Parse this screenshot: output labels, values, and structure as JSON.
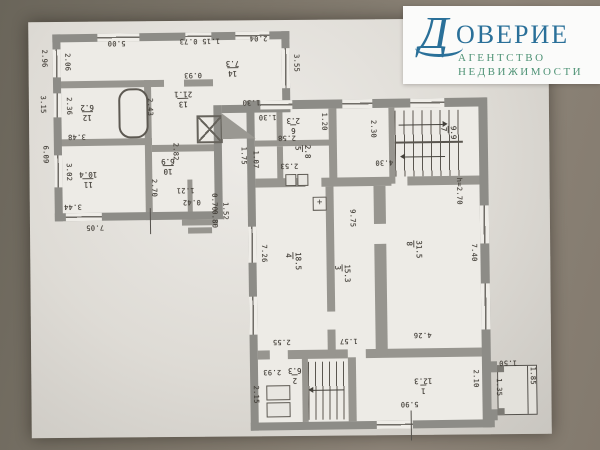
{
  "logo": {
    "brand_initial": "Д",
    "brand_rest": "ОВЕРИЕ",
    "tagline_line1": "АГЕНТСТВО",
    "tagline_line2": "НЕДВИЖИМОСТИ"
  },
  "colors": {
    "logo_blue": "#2a7099",
    "logo_green": "#4f9376",
    "paper": "#dedbd5",
    "wall_grey": "#8d8c87",
    "background": "#7b7468"
  },
  "symbols": {
    "cross_box": "+"
  },
  "plan": {
    "height_note": "h=2.70",
    "room_labels": [
      {
        "num": "13",
        "area": "21.1",
        "x": 176,
        "y": 88,
        "rot": 180
      },
      {
        "num": "12",
        "area": "6.2",
        "x": 82,
        "y": 100,
        "rot": 180
      },
      {
        "num": "14",
        "area": "7.3",
        "x": 228,
        "y": 58,
        "rot": 180
      },
      {
        "num": "11",
        "area": "10.4",
        "x": 80,
        "y": 167,
        "rot": 180
      },
      {
        "num": "10",
        "area": "6.9",
        "x": 162,
        "y": 155,
        "rot": 180
      },
      {
        "num": "6",
        "area": "2.3",
        "x": 288,
        "y": 116,
        "rot": 180
      },
      {
        "num": "5",
        "area": "2.8",
        "x": 294,
        "y": 145,
        "rot": 90
      },
      {
        "num": "7",
        "area": "9.9",
        "x": 440,
        "y": 128,
        "rot": 90
      },
      {
        "num": "4",
        "area": "18.5",
        "x": 283,
        "y": 252,
        "rot": 90
      },
      {
        "num": "3",
        "area": "15.3",
        "x": 332,
        "y": 265,
        "rot": 90
      },
      {
        "num": "8",
        "area": "31.5",
        "x": 404,
        "y": 242,
        "rot": 90
      },
      {
        "num": "2",
        "area": "6.3",
        "x": 286,
        "y": 366,
        "rot": 180
      },
      {
        "num": "1",
        "area": "12.3",
        "x": 412,
        "y": 378,
        "rot": 180
      }
    ],
    "dimensions": [
      {
        "text": "2.96",
        "x": 42,
        "y": 46,
        "rot": 90
      },
      {
        "text": "3.15",
        "x": 40,
        "y": 92,
        "rot": 90
      },
      {
        "text": "6.09",
        "x": 42,
        "y": 142,
        "rot": 90
      },
      {
        "text": "2.06",
        "x": 65,
        "y": 50,
        "rot": 90
      },
      {
        "text": "5.00",
        "x": 110,
        "y": 36,
        "rot": 180
      },
      {
        "text": "1.15 0.73",
        "x": 182,
        "y": 35,
        "rot": 180
      },
      {
        "text": "2.04",
        "x": 252,
        "y": 33,
        "rot": 180
      },
      {
        "text": "3.55",
        "x": 294,
        "y": 54,
        "rot": 90
      },
      {
        "text": "0.93",
        "x": 186,
        "y": 69,
        "rot": 180
      },
      {
        "text": "1.30",
        "x": 244,
        "y": 97,
        "rot": 180
      },
      {
        "text": "2.36",
        "x": 66,
        "y": 94,
        "rot": 90
      },
      {
        "text": "2.43",
        "x": 147,
        "y": 96,
        "rot": 90
      },
      {
        "text": "3.48",
        "x": 69,
        "y": 129,
        "rot": 180
      },
      {
        "text": "3.02",
        "x": 65,
        "y": 160,
        "rot": 90
      },
      {
        "text": "2.70",
        "x": 150,
        "y": 177,
        "rot": 90
      },
      {
        "text": "2.82",
        "x": 172,
        "y": 141,
        "rot": 90
      },
      {
        "text": "1.21",
        "x": 177,
        "y": 184,
        "rot": 180
      },
      {
        "text": "0.42",
        "x": 183,
        "y": 196,
        "rot": 180
      },
      {
        "text": "0.70",
        "x": 210,
        "y": 192,
        "rot": 90
      },
      {
        "text": "0.80",
        "x": 210,
        "y": 209,
        "rot": 90
      },
      {
        "text": "1.52",
        "x": 221,
        "y": 201,
        "rot": 90
      },
      {
        "text": "3.44",
        "x": 64,
        "y": 199,
        "rot": 180
      },
      {
        "text": "7.05",
        "x": 86,
        "y": 220,
        "rot": 180
      },
      {
        "text": "1.75",
        "x": 240,
        "y": 146,
        "rot": 90
      },
      {
        "text": "1.07",
        "x": 252,
        "y": 150,
        "rot": 90
      },
      {
        "text": "1.30",
        "x": 260,
        "y": 112,
        "rot": 180
      },
      {
        "text": "2.58",
        "x": 279,
        "y": 133,
        "rot": 180
      },
      {
        "text": "2.53",
        "x": 281,
        "y": 161,
        "rot": 180
      },
      {
        "text": "1.20",
        "x": 321,
        "y": 113,
        "rot": 90
      },
      {
        "text": "2.30",
        "x": 370,
        "y": 121,
        "rot": 90
      },
      {
        "text": "4.30",
        "x": 376,
        "y": 159,
        "rot": 180
      },
      {
        "text": "9.75",
        "x": 348,
        "y": 210,
        "rot": 90
      },
      {
        "text": "7.26",
        "x": 259,
        "y": 244,
        "rot": 90
      },
      {
        "text": "h=2.70",
        "x": 455,
        "y": 180,
        "rot": 90
      },
      {
        "text": "7.40",
        "x": 469,
        "y": 246,
        "rot": 90
      },
      {
        "text": "2.55",
        "x": 271,
        "y": 337,
        "rot": 180
      },
      {
        "text": "1.57",
        "x": 338,
        "y": 337,
        "rot": 180
      },
      {
        "text": "4.26",
        "x": 412,
        "y": 332,
        "rot": 180
      },
      {
        "text": "2.93",
        "x": 261,
        "y": 367,
        "rot": 180
      },
      {
        "text": "2.15",
        "x": 249,
        "y": 385,
        "rot": 90
      },
      {
        "text": "5.90",
        "x": 398,
        "y": 401,
        "rot": 180
      },
      {
        "text": "2.10",
        "x": 469,
        "y": 372,
        "rot": 90
      },
      {
        "text": "1.50",
        "x": 497,
        "y": 361,
        "rot": 180
      },
      {
        "text": "1.35",
        "x": 492,
        "y": 381,
        "rot": 90
      },
      {
        "text": "1.85",
        "x": 526,
        "y": 370,
        "rot": 90
      }
    ]
  }
}
